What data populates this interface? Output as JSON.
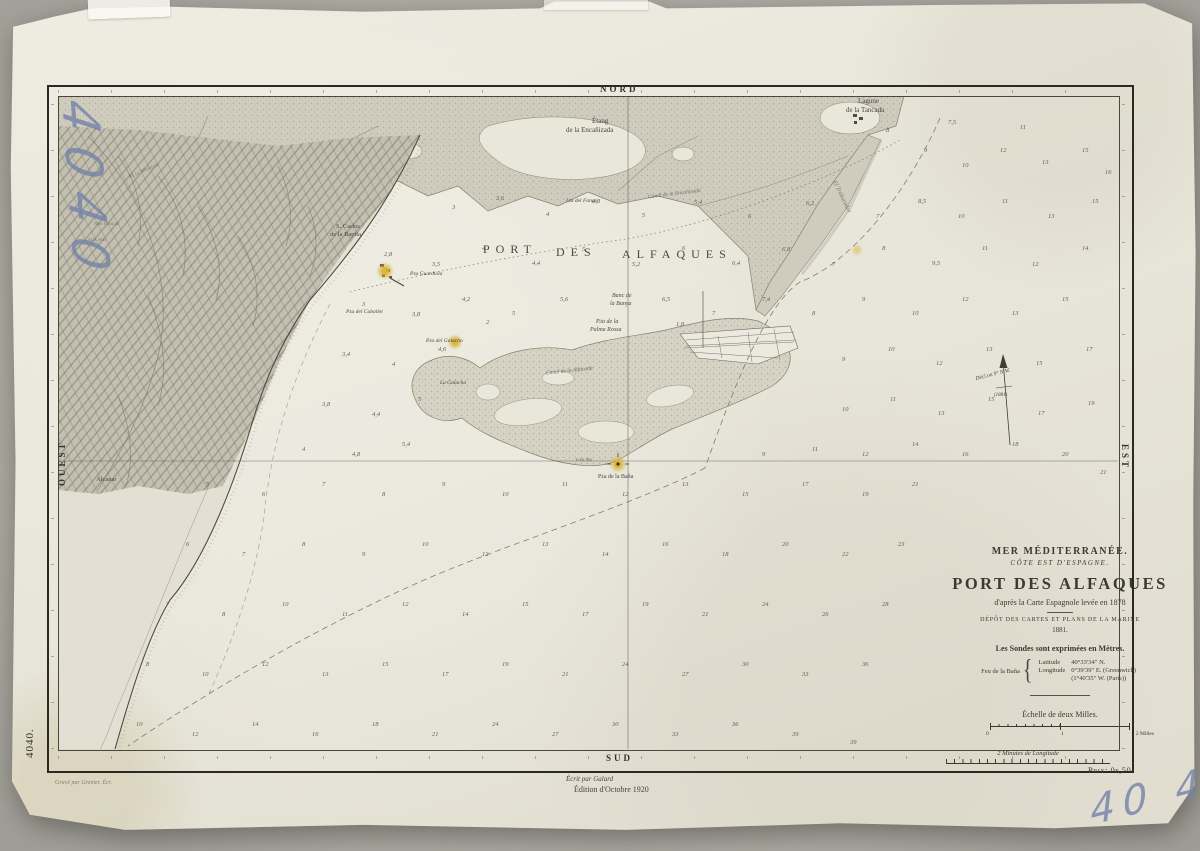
{
  "margins": {
    "north": "NORD",
    "south": "SUD",
    "west": "OUEST",
    "east": "EST",
    "plate_number": "4040.",
    "price": "Prix: 0f,50",
    "minutes_scale": "2 Minutes de Longitude",
    "engraver": "Gravé par Grenier.      Écr.",
    "writer": "Écrit par Galard",
    "edition": "Édition d'Octobre 1920"
  },
  "handwriting": {
    "top_left": "4040",
    "bottom_right": "40 40"
  },
  "title_block": {
    "sea": "MER MÉDITERRANÉE.",
    "coast": "CÔTE EST D'ESPAGNE.",
    "title": "PORT DES ALFAQUES",
    "source": "d'après la Carte Espagnole levée en 1878",
    "depot": "DÉPÔT DES CARTES ET PLANS DE LA MARINE",
    "year": "1881.",
    "soundings_note": "Les Sondes sont exprimées en Mètres.",
    "light_name": "Feu de la Baña",
    "lat_label": "Latitude",
    "lat_value": "40°33′34″ N.",
    "lon_label": "Longitude",
    "lon_value": "0°39′39″ E. (Greenwich)",
    "lon_paris": "(1°40′35″ W. (Paris))",
    "scale_label": "Échelle de deux Milles.",
    "scale_tick_0": "0",
    "scale_tick_1": "1",
    "scale_tick_2": "2 Milles"
  },
  "declination": {
    "line1": "Décl.on 9° N.W.",
    "line2": "(1881)"
  },
  "labels": [
    {
      "t": "PORT",
      "x": 483,
      "y": 243,
      "fs": 12,
      "ls": 6
    },
    {
      "t": "DES",
      "x": 556,
      "y": 246,
      "fs": 12,
      "ls": 6
    },
    {
      "t": "ALFAQUES",
      "x": 622,
      "y": 248,
      "fs": 12,
      "ls": 6
    },
    {
      "t": "Étang",
      "x": 592,
      "y": 118,
      "fs": 7
    },
    {
      "t": "de la Encañizada",
      "x": 566,
      "y": 127,
      "fs": 7
    },
    {
      "t": "Lagune",
      "x": 858,
      "y": 98,
      "fs": 7
    },
    {
      "t": "de la Tancada",
      "x": 846,
      "y": 107,
      "fs": 7
    },
    {
      "t": "S. Carlos",
      "x": 336,
      "y": 224,
      "fs": 6.5
    },
    {
      "t": "de la Rapita",
      "x": 330,
      "y": 232,
      "fs": 6.5
    },
    {
      "t": "P.ta Guardiola",
      "x": 410,
      "y": 272,
      "fs": 5.5,
      "it": 1
    },
    {
      "t": "P.ta del Caballet",
      "x": 346,
      "y": 310,
      "fs": 5.5,
      "it": 1
    },
    {
      "t": "P.ta del Galacho",
      "x": 426,
      "y": 339,
      "fs": 5.5,
      "it": 1
    },
    {
      "t": "La Galacha",
      "x": 440,
      "y": 381,
      "fs": 5.5,
      "it": 1
    },
    {
      "t": "Banc de",
      "x": 612,
      "y": 293,
      "fs": 6,
      "it": 1
    },
    {
      "t": "la Banya",
      "x": 610,
      "y": 301,
      "fs": 6,
      "it": 1
    },
    {
      "t": "P.ta de la",
      "x": 596,
      "y": 319,
      "fs": 6,
      "it": 1
    },
    {
      "t": "Palma Rossa",
      "x": 590,
      "y": 327,
      "fs": 6,
      "it": 1
    },
    {
      "t": "Canal de la Alfacada",
      "x": 546,
      "y": 369,
      "fs": 5.5,
      "it": 1,
      "rot": -6,
      "op": 0.8
    },
    {
      "t": "P.ta de la Baña",
      "x": 598,
      "y": 474,
      "fs": 6
    },
    {
      "t": "F.eu 9m",
      "x": 576,
      "y": 458,
      "fs": 5,
      "it": 1,
      "op": 0.8
    },
    {
      "t": "Alcanar",
      "x": 96,
      "y": 477,
      "fs": 6.5
    },
    {
      "t": "M.te Montsia",
      "x": 128,
      "y": 168,
      "fs": 6,
      "rot": -24,
      "op": 0.5
    },
    {
      "t": "Mas Pasqual",
      "x": 94,
      "y": 222,
      "fs": 5,
      "op": 0.5
    },
    {
      "t": "Mas Mar",
      "x": 88,
      "y": 238,
      "fs": 5,
      "op": 0.5
    },
    {
      "t": "El Trabucador",
      "x": 824,
      "y": 194,
      "fs": 6,
      "rot": 64,
      "it": 1,
      "op": 0.65
    },
    {
      "t": "Canal de la Encañizada",
      "x": 648,
      "y": 192,
      "fs": 5.5,
      "rot": -7,
      "it": 1,
      "op": 0.7
    },
    {
      "t": "I.ta del Fango",
      "x": 566,
      "y": 199,
      "fs": 5.5,
      "it": 1
    }
  ],
  "soundings": [
    [
      886,
      128,
      "8"
    ],
    [
      924,
      148,
      "9"
    ],
    [
      962,
      163,
      "10"
    ],
    [
      1000,
      148,
      "12"
    ],
    [
      1042,
      160,
      "13"
    ],
    [
      1082,
      148,
      "15"
    ],
    [
      1105,
      170,
      "16"
    ],
    [
      948,
      120,
      "7,5"
    ],
    [
      1020,
      125,
      "11"
    ],
    [
      452,
      205,
      "3"
    ],
    [
      496,
      196,
      "3,6"
    ],
    [
      546,
      212,
      "4"
    ],
    [
      592,
      199,
      "4,8"
    ],
    [
      642,
      213,
      "5"
    ],
    [
      694,
      200,
      "5,4"
    ],
    [
      748,
      214,
      "6"
    ],
    [
      806,
      201,
      "6,2"
    ],
    [
      876,
      214,
      "7"
    ],
    [
      918,
      199,
      "8,5"
    ],
    [
      958,
      214,
      "10"
    ],
    [
      1002,
      199,
      "11"
    ],
    [
      1048,
      214,
      "13"
    ],
    [
      1092,
      199,
      "15"
    ],
    [
      384,
      252,
      "2,8"
    ],
    [
      432,
      262,
      "3,5"
    ],
    [
      482,
      246,
      "4"
    ],
    [
      532,
      261,
      "4,4"
    ],
    [
      582,
      247,
      "5"
    ],
    [
      632,
      262,
      "5,2"
    ],
    [
      682,
      246,
      "6"
    ],
    [
      732,
      261,
      "6,4"
    ],
    [
      782,
      247,
      "6,8"
    ],
    [
      832,
      262,
      "7"
    ],
    [
      882,
      246,
      "8"
    ],
    [
      932,
      261,
      "9,5"
    ],
    [
      982,
      246,
      "11"
    ],
    [
      1032,
      262,
      "12"
    ],
    [
      1082,
      246,
      "14"
    ],
    [
      362,
      302,
      "3"
    ],
    [
      412,
      312,
      "3,8"
    ],
    [
      462,
      297,
      "4,2"
    ],
    [
      512,
      311,
      "5"
    ],
    [
      560,
      297,
      "5,6"
    ],
    [
      662,
      297,
      "6,5"
    ],
    [
      712,
      311,
      "7"
    ],
    [
      762,
      297,
      "7,4"
    ],
    [
      812,
      311,
      "8"
    ],
    [
      862,
      297,
      "9"
    ],
    [
      912,
      311,
      "10"
    ],
    [
      962,
      297,
      "12"
    ],
    [
      1012,
      311,
      "13"
    ],
    [
      1062,
      297,
      "15"
    ],
    [
      486,
      320,
      "2"
    ],
    [
      676,
      322,
      "1,8"
    ],
    [
      342,
      352,
      "3,4"
    ],
    [
      392,
      362,
      "4"
    ],
    [
      438,
      347,
      "4,6"
    ],
    [
      842,
      357,
      "9"
    ],
    [
      888,
      347,
      "10"
    ],
    [
      936,
      361,
      "12"
    ],
    [
      986,
      347,
      "13"
    ],
    [
      1036,
      361,
      "15"
    ],
    [
      1086,
      347,
      "17"
    ],
    [
      322,
      402,
      "3,8"
    ],
    [
      372,
      412,
      "4,4"
    ],
    [
      418,
      397,
      "5"
    ],
    [
      842,
      407,
      "10"
    ],
    [
      890,
      397,
      "11"
    ],
    [
      938,
      411,
      "13"
    ],
    [
      988,
      397,
      "15"
    ],
    [
      1038,
      411,
      "17"
    ],
    [
      1088,
      401,
      "19"
    ],
    [
      302,
      447,
      "4"
    ],
    [
      352,
      452,
      "4,8"
    ],
    [
      402,
      442,
      "5,4"
    ],
    [
      762,
      452,
      "9"
    ],
    [
      812,
      447,
      "11"
    ],
    [
      862,
      452,
      "12"
    ],
    [
      912,
      442,
      "14"
    ],
    [
      962,
      452,
      "16"
    ],
    [
      1012,
      442,
      "18"
    ],
    [
      1062,
      452,
      "20"
    ],
    [
      1100,
      470,
      "21"
    ],
    [
      206,
      482,
      "5"
    ],
    [
      262,
      492,
      "6"
    ],
    [
      322,
      482,
      "7"
    ],
    [
      382,
      492,
      "8"
    ],
    [
      442,
      482,
      "9"
    ],
    [
      502,
      492,
      "10"
    ],
    [
      562,
      482,
      "11"
    ],
    [
      622,
      492,
      "12"
    ],
    [
      682,
      482,
      "13"
    ],
    [
      742,
      492,
      "15"
    ],
    [
      802,
      482,
      "17"
    ],
    [
      862,
      492,
      "19"
    ],
    [
      912,
      482,
      "21"
    ],
    [
      186,
      542,
      "6"
    ],
    [
      242,
      552,
      "7"
    ],
    [
      302,
      542,
      "8"
    ],
    [
      362,
      552,
      "9"
    ],
    [
      422,
      542,
      "10"
    ],
    [
      482,
      552,
      "12"
    ],
    [
      542,
      542,
      "13"
    ],
    [
      602,
      552,
      "14"
    ],
    [
      662,
      542,
      "16"
    ],
    [
      722,
      552,
      "18"
    ],
    [
      782,
      542,
      "20"
    ],
    [
      842,
      552,
      "22"
    ],
    [
      898,
      542,
      "23"
    ],
    [
      166,
      602,
      "7"
    ],
    [
      222,
      612,
      "8"
    ],
    [
      282,
      602,
      "10"
    ],
    [
      342,
      612,
      "11"
    ],
    [
      402,
      602,
      "12"
    ],
    [
      462,
      612,
      "14"
    ],
    [
      522,
      602,
      "15"
    ],
    [
      582,
      612,
      "17"
    ],
    [
      642,
      602,
      "19"
    ],
    [
      702,
      612,
      "21"
    ],
    [
      762,
      602,
      "24"
    ],
    [
      822,
      612,
      "26"
    ],
    [
      882,
      602,
      "28"
    ],
    [
      146,
      662,
      "8"
    ],
    [
      202,
      672,
      "10"
    ],
    [
      262,
      662,
      "12"
    ],
    [
      322,
      672,
      "13"
    ],
    [
      382,
      662,
      "15"
    ],
    [
      442,
      672,
      "17"
    ],
    [
      502,
      662,
      "19"
    ],
    [
      562,
      672,
      "21"
    ],
    [
      622,
      662,
      "24"
    ],
    [
      682,
      672,
      "27"
    ],
    [
      742,
      662,
      "30"
    ],
    [
      802,
      672,
      "33"
    ],
    [
      862,
      662,
      "36"
    ],
    [
      136,
      722,
      "10"
    ],
    [
      192,
      732,
      "12"
    ],
    [
      252,
      722,
      "14"
    ],
    [
      312,
      732,
      "16"
    ],
    [
      372,
      722,
      "18"
    ],
    [
      432,
      732,
      "21"
    ],
    [
      492,
      722,
      "24"
    ],
    [
      552,
      732,
      "27"
    ],
    [
      612,
      722,
      "30"
    ],
    [
      672,
      732,
      "33"
    ],
    [
      732,
      722,
      "36"
    ],
    [
      792,
      732,
      "39"
    ],
    [
      850,
      740,
      "39"
    ]
  ]
}
